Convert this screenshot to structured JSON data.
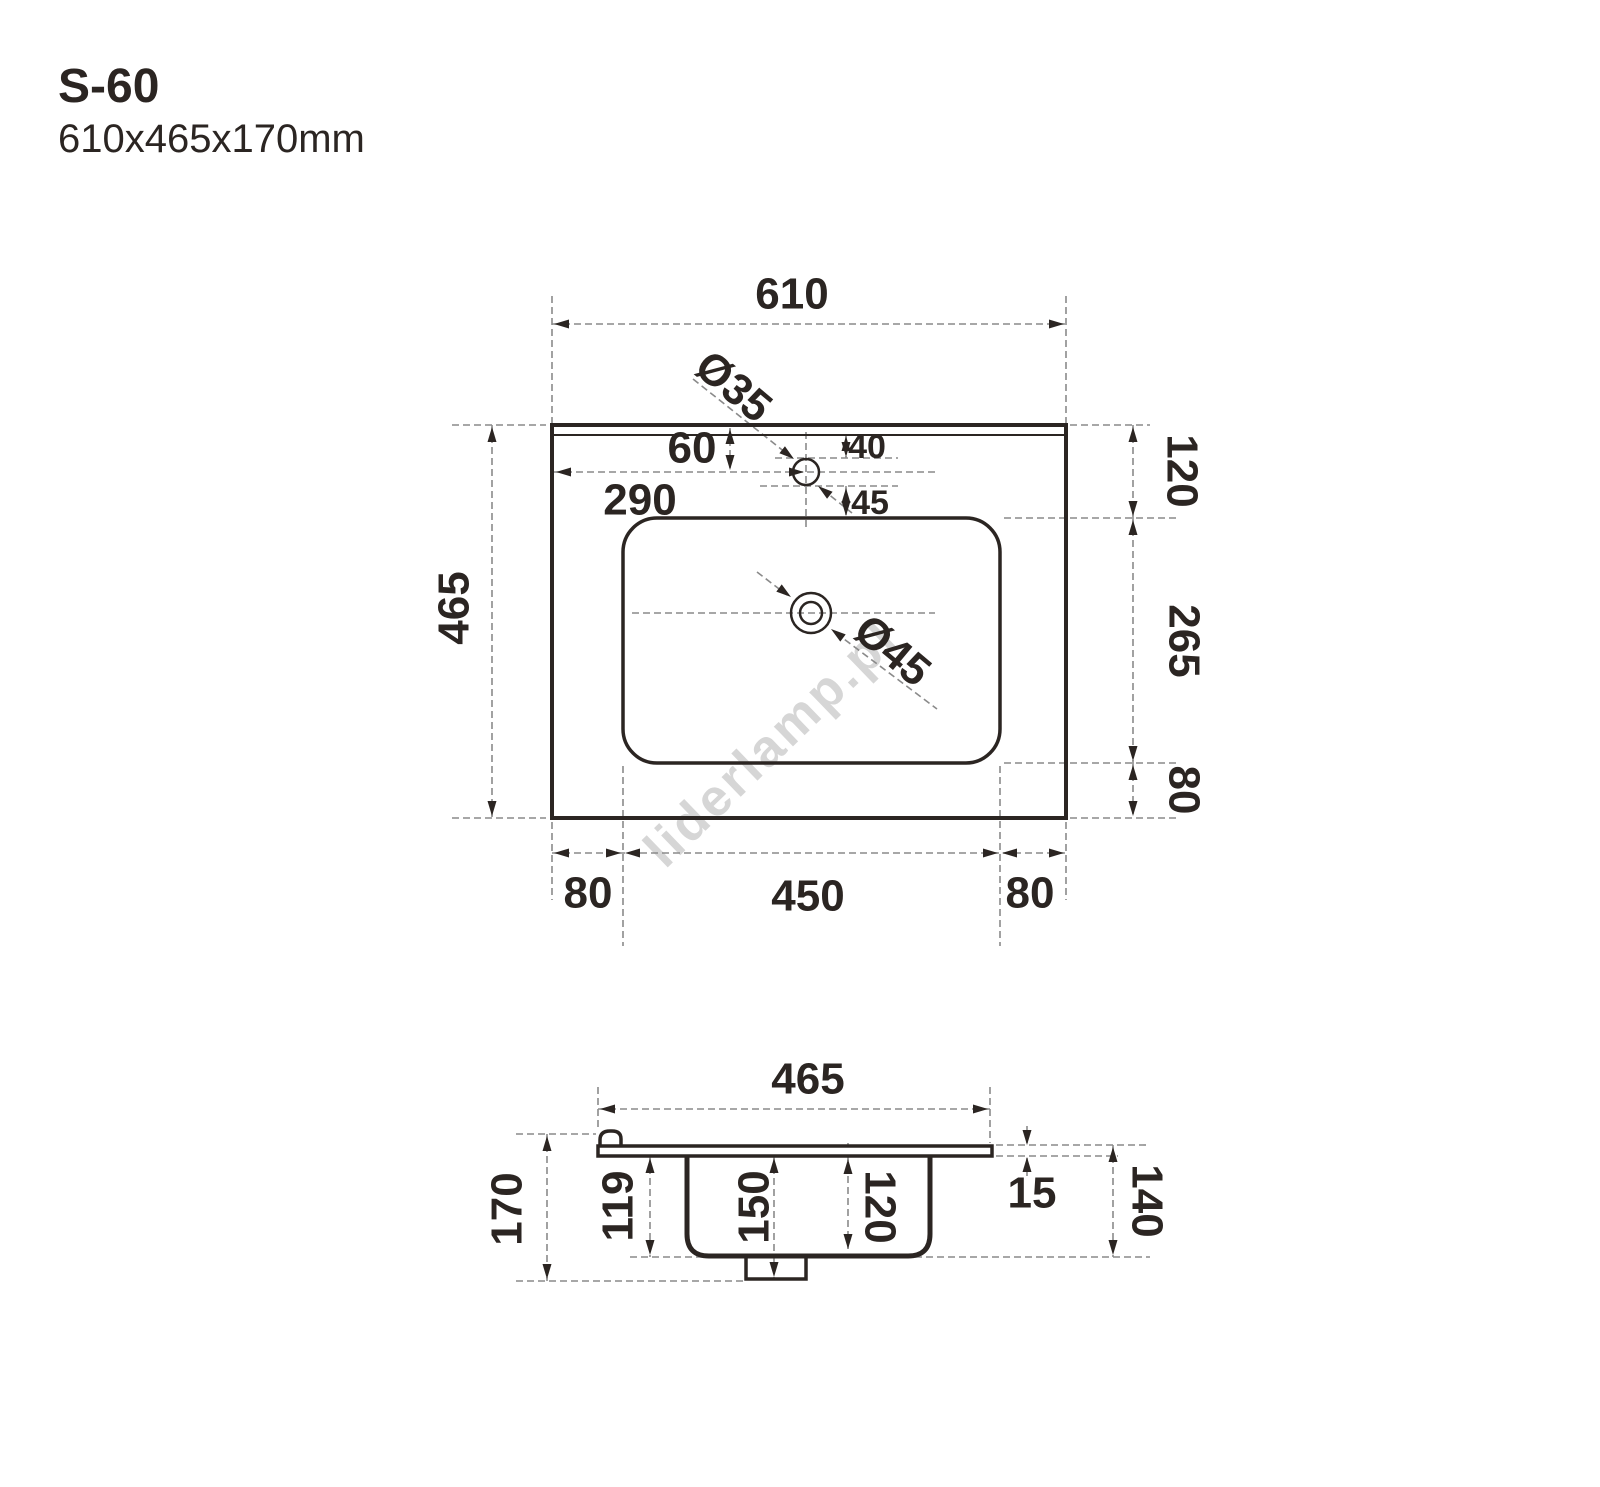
{
  "header": {
    "model": "S-60",
    "dimensions": "610x465x170mm"
  },
  "watermark": {
    "text": "liderlamp.pl"
  },
  "colors": {
    "line": "#2b2522",
    "dash": "#8a8a8a",
    "watermark": "#d6d6d6"
  },
  "top_view": {
    "overall_width": "610",
    "overall_depth": "465",
    "faucet_hole_diameter": "Ø35",
    "faucet_offset_top": "60",
    "faucet_offset_left": "290",
    "faucet_to_rim": "40",
    "faucet_to_basin": "45",
    "basin_offset_top": "120",
    "basin_depth": "265",
    "basin_offset_bottom": "80",
    "margin_left": "80",
    "basin_width": "450",
    "margin_right": "80",
    "drain_diameter": "Ø45"
  },
  "section_view": {
    "depth": "465",
    "total_height": "170",
    "basin_outer_depth": "119",
    "drain_height": "150",
    "basin_inner_depth": "120",
    "rim_thickness": "15",
    "height_right": "140"
  }
}
